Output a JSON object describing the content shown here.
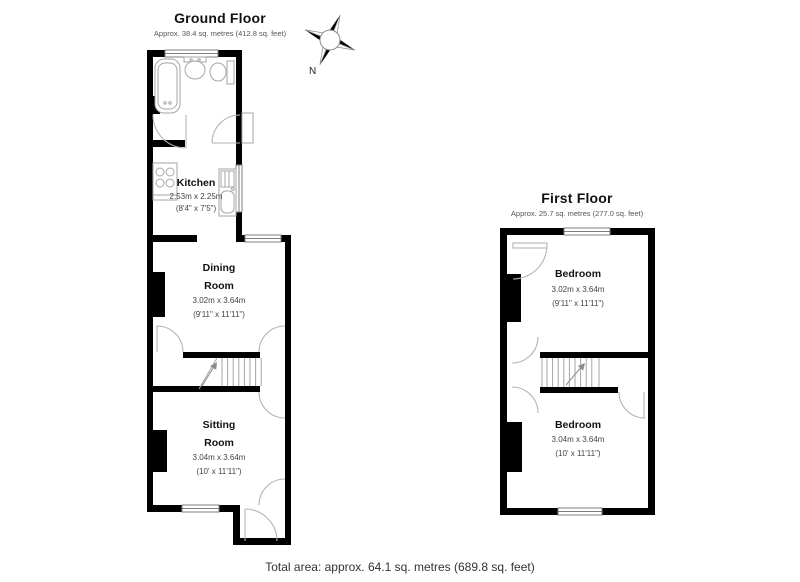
{
  "ground_floor": {
    "title": "Ground Floor",
    "subtitle": "Approx. 38.4 sq. metres (412.8 sq. feet)",
    "rooms": {
      "kitchen": {
        "name": "Kitchen",
        "dims_metric": "2.53m x 2.25m",
        "dims_imperial": "(8'4\" x 7'5\")"
      },
      "dining": {
        "name_line1": "Dining",
        "name_line2": "Room",
        "dims_metric": "3.02m x 3.64m",
        "dims_imperial": "(9'11\" x 11'11\")"
      },
      "sitting": {
        "name_line1": "Sitting",
        "name_line2": "Room",
        "dims_metric": "3.04m x 3.64m",
        "dims_imperial": "(10' x 11'11\")"
      }
    }
  },
  "first_floor": {
    "title": "First Floor",
    "subtitle": "Approx. 25.7 sq. metres (277.0 sq. feet)",
    "rooms": {
      "bedroom_front": {
        "name": "Bedroom",
        "dims_metric": "3.02m x 3.64m",
        "dims_imperial": "(9'11\" x 11'11\")"
      },
      "bedroom_back": {
        "name": "Bedroom",
        "dims_metric": "3.04m x 3.64m",
        "dims_imperial": "(10' x 11'11\")"
      }
    }
  },
  "compass": {
    "north_label": "N"
  },
  "footer": {
    "total_area": "Total area: approx. 64.1 sq. metres (689.8 sq. feet)"
  },
  "colors": {
    "wall": "#000000",
    "fixture_line": "#a6a6a6",
    "window_line": "#7f7f7f",
    "text_primary": "#111111",
    "text_secondary": "#555555"
  }
}
